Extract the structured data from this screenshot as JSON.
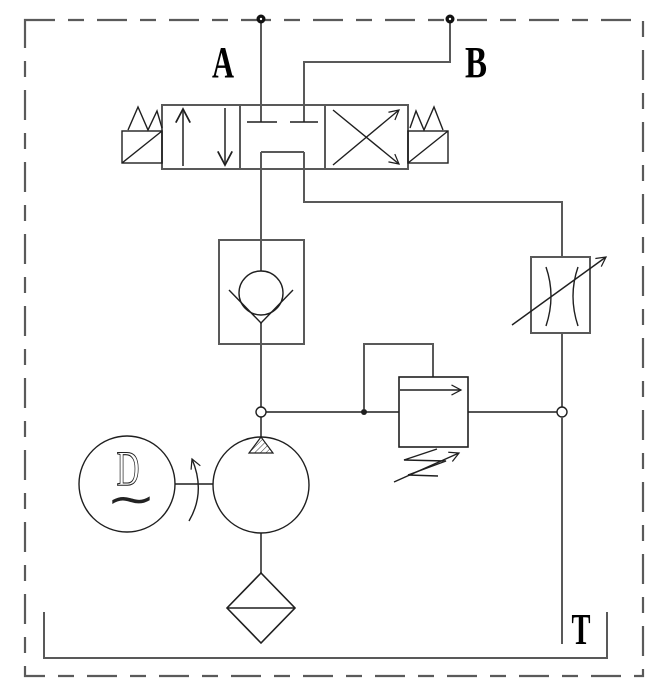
{
  "diagram": {
    "type": "hydraulic-circuit-schematic",
    "labels": {
      "port_a": "A",
      "port_b": "B",
      "tank": "T",
      "motor_letter": "D",
      "motor_wave": "∼"
    },
    "colors": {
      "background": "#ffffff",
      "connection_line": "#595959",
      "component_line": "#1f1f1f",
      "label_text": "#000000"
    },
    "components": [
      "4/3 solenoid directional control valve",
      "check valve",
      "variable flow control valve",
      "pilot operated relief valve",
      "electric motor",
      "hydraulic pump",
      "suction filter",
      "reservoir tank"
    ]
  }
}
